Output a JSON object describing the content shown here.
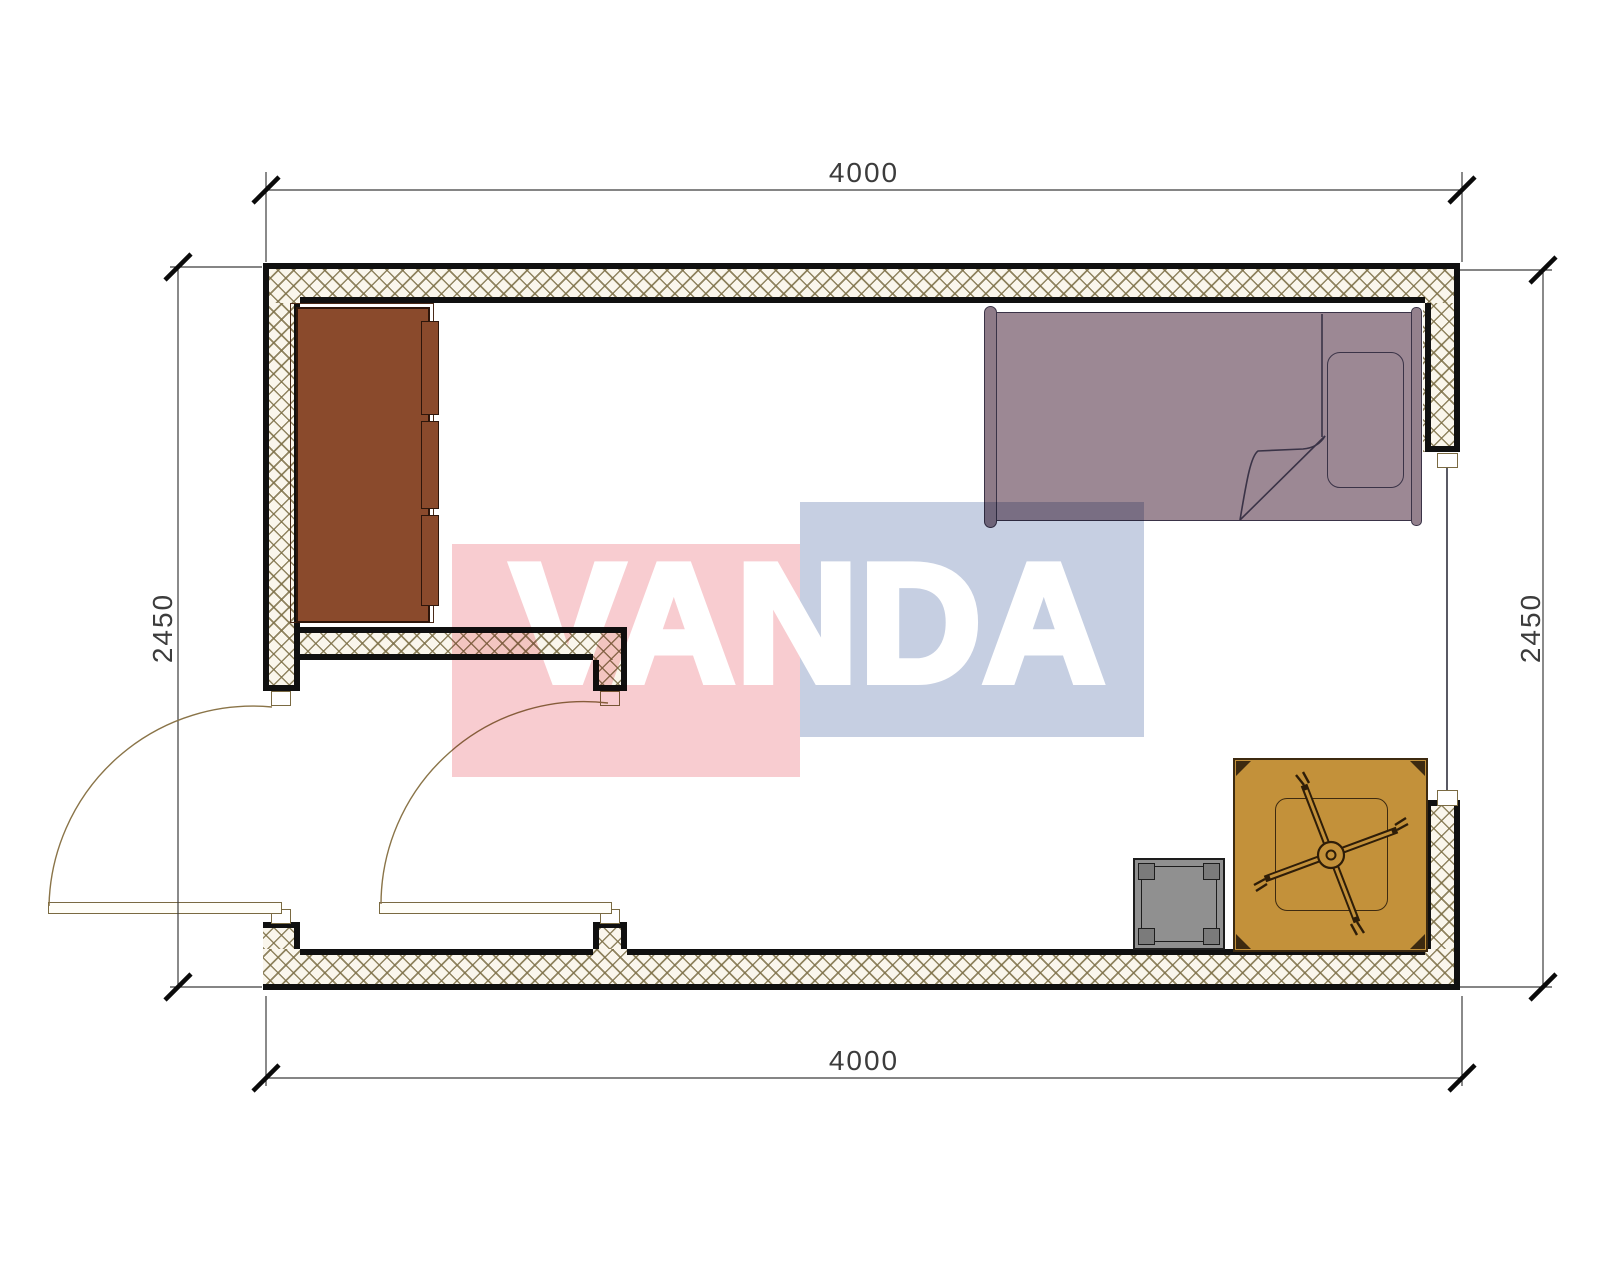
{
  "title": "Room floor plan 4000 x 2450 with furniture",
  "watermark": {
    "text": "VANDA",
    "pink_block_color": "#e85664",
    "blue_block_color": "#4260a0",
    "text_color": "#ffffff"
  },
  "dimensions": {
    "top": "4000",
    "bottom": "4000",
    "left": "2450",
    "right": "2450"
  },
  "palette": {
    "wall_line": "#101010",
    "wall_hatch_bg": "#faf6ec",
    "wall_hatch_line": "#7d7048",
    "wardrobe": "#8a4a2c",
    "bed": "#9c8894",
    "table": "#c3913a",
    "stool": "#909090",
    "door": "#7a6a42",
    "dimension": "#3c3c3c"
  },
  "furniture": [
    {
      "name": "wardrobe",
      "location": "top-left"
    },
    {
      "name": "single-bed",
      "location": "top-right"
    },
    {
      "name": "low-table-with-ceiling-fan",
      "location": "bottom-right"
    },
    {
      "name": "stool",
      "location": "bottom-right"
    }
  ],
  "openings": [
    {
      "name": "entry-door",
      "wall": "left-bottom"
    },
    {
      "name": "interior-door",
      "wall": "vestibule-partition"
    },
    {
      "name": "window",
      "wall": "right"
    }
  ]
}
